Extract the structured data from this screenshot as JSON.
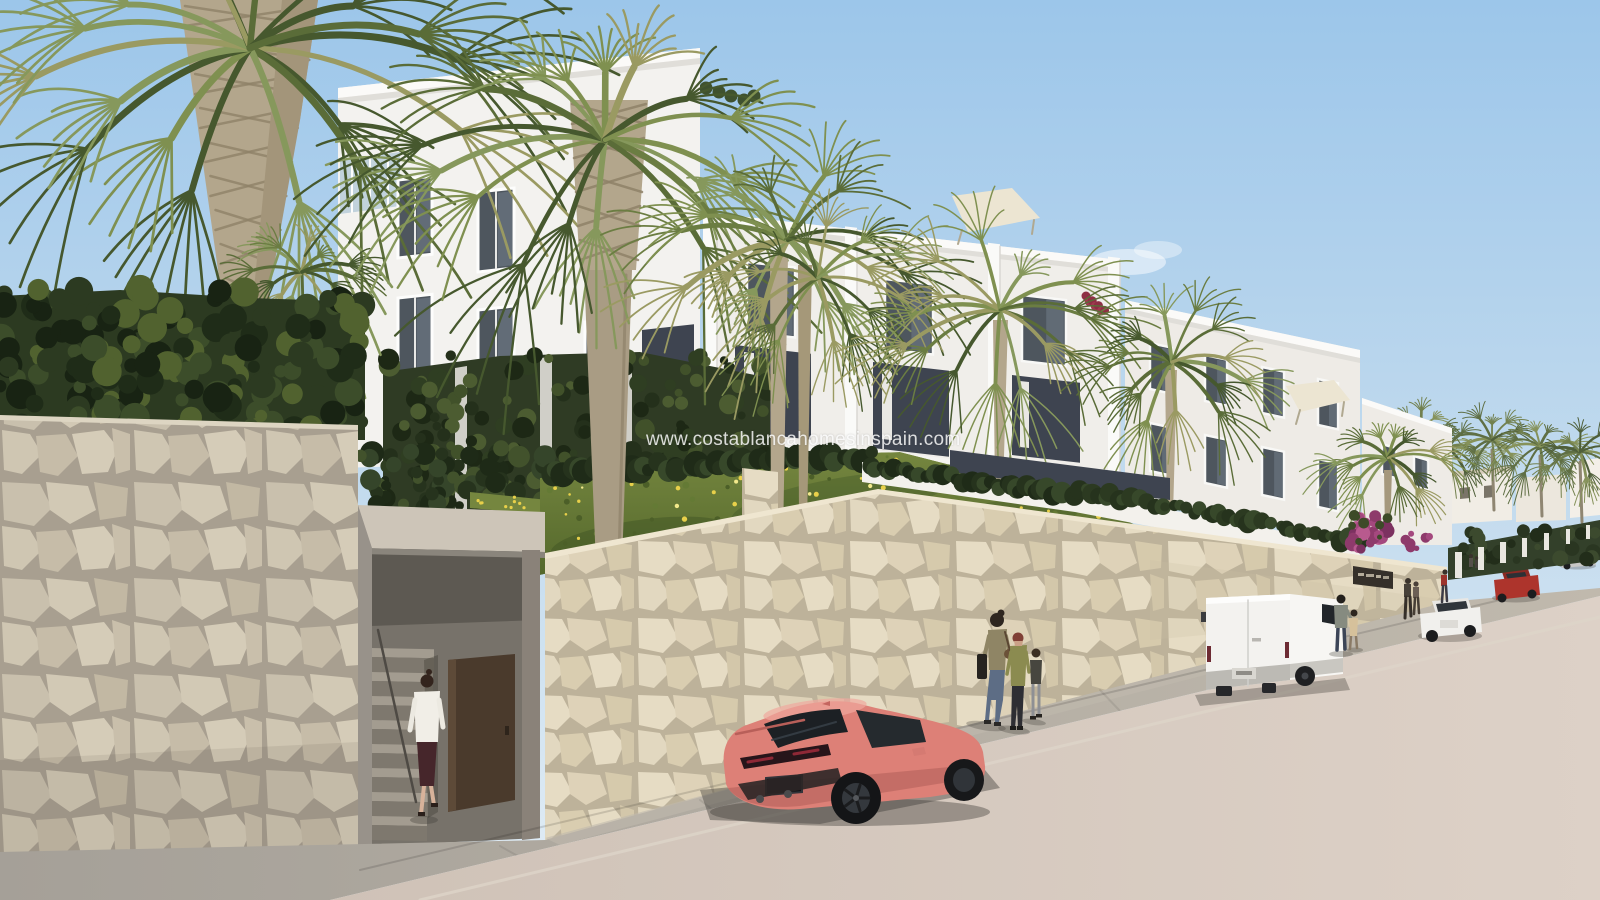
{
  "watermark": {
    "text": "www.costablancahomesinspain.com"
  },
  "scene": {
    "type": "architectural-render",
    "description": "New-build white Mediterranean apartment complex stepping down a hillside street, behind cream stone retaining walls, with fan palm trees, a grass slope with yellow wildflowers, a recessed stair entrance with an open brown gate, a coral sports coupe and a white panel van parked on the road, and pedestrians on the sidewalk; distant villas and palms line the rising street to the right",
    "objects": [
      "white-apartment-buildings",
      "fan-palm-trees",
      "stone-retaining-walls",
      "entrance-stairs-with-open-door",
      "woman-walking-to-entrance",
      "coral-sports-car",
      "white-delivery-van",
      "family-pedestrians",
      "man-with-child",
      "distant-cars",
      "grass-slope-with-flowers",
      "hedges-and-ivy",
      "bougainvillea",
      "rooftop-awnings",
      "distant-villas",
      "wall-name-plaque"
    ],
    "entrance_sign": {
      "present": true,
      "text_legible": false
    }
  },
  "colors": {
    "skyTop": "#9cc6ea",
    "skyMid": "#c3dbee",
    "skyHorizon": "#e2edf5",
    "buildingFace": "#f3f2ef",
    "buildingFace2": "#f0eeea",
    "buildingFace3": "#eeebe6",
    "buildingParapet": "#fbfaf8",
    "buildingShade": "#e0ded9",
    "windowGlass": "#4e565e",
    "windowGlassLight": "#73808c",
    "recessDark": "#3e4450",
    "stoneLight": "#cbc2af",
    "stoneMortar": "#a89f90",
    "stoneWarm": "#e0d5bd",
    "stoneWarmMortar": "#bdb29a",
    "grass": "#75863f",
    "grassDark": "#54682c",
    "hedge": "#2c3a21",
    "hedgeLight": "#49592e",
    "palm": "#5a6c38",
    "palmLight": "#86985299",
    "palmDry": "#9a9a62",
    "trunk": "#b3a68c",
    "trunkShade": "#8f8268",
    "road": "#cfc2b7",
    "roadFar": "#ddd1c7",
    "sidewalk": "#a5a098",
    "sidewalkLit": "#c0b9ad",
    "curb": "#ddd6ca",
    "carCoral": "#dd8077",
    "carCoralDark": "#c06a63",
    "carCoralLight": "#f0a89e",
    "vanWhite": "#f3f2ef",
    "vanSkirt": "#bcbab4",
    "doorBrown": "#4a3a2c",
    "concrete": "#9a948a",
    "awning": "#ece5d2",
    "bougainvillea": "#a4487e",
    "flowerYellow": "#e8d04a",
    "redCar": "#ad342c",
    "silverCar": "#c8c7c5",
    "whiteCar": "#f1f0ed",
    "skin": "#d7b29a",
    "shadow": "#3f3b36"
  }
}
